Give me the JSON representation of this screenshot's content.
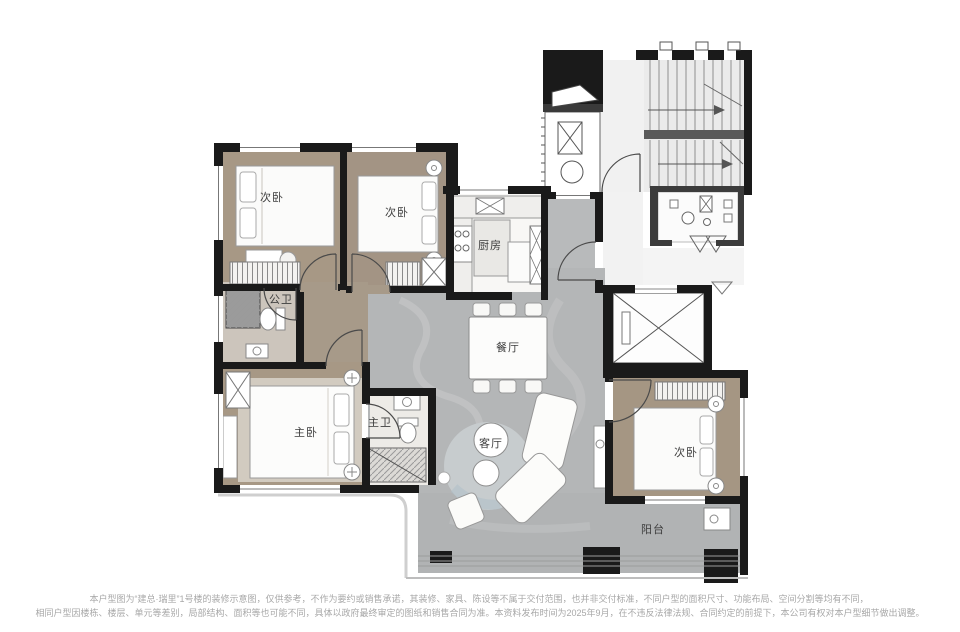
{
  "plan": {
    "title": "户型图",
    "rooms": {
      "bedroom_top_left": "次卧",
      "bedroom_top_mid": "次卧",
      "public_bath": "公卫",
      "master_bedroom": "主卧",
      "master_bath": "主卫",
      "kitchen": "厨房",
      "dining": "餐厅",
      "living": "客厅",
      "bedroom_right": "次卧",
      "balcony": "阳台"
    },
    "colors": {
      "wall": "#1a1a1a",
      "bedroom_floor": "#a79885",
      "living_floor": "#b4b6b7",
      "public_bath_floor": "#ccc5bc",
      "master_bath_floor": "#edebe7",
      "kitchen_floor": "#f8f7f5",
      "common_area": "#ededed"
    }
  },
  "disclaimer": {
    "line1": "本户型图为“建总·瑞里”1号楼的装修示意图，仅供参考，不作为要约或销售承诺，其装修、家具、陈设等不属于交付范围，也并非交付标准，不同户型的面积尺寸、功能布局、空间分割等均有不同，",
    "line2": "相同户型因楼栋、楼层、单元等差别，局部结构、面积等也可能不同，具体以政府最终审定的图纸和销售合同为准。本资料发布时间为2025年9月，在不违反法律法规、合同约定的前提下，本公司有权对本户型细节做出调整。"
  }
}
